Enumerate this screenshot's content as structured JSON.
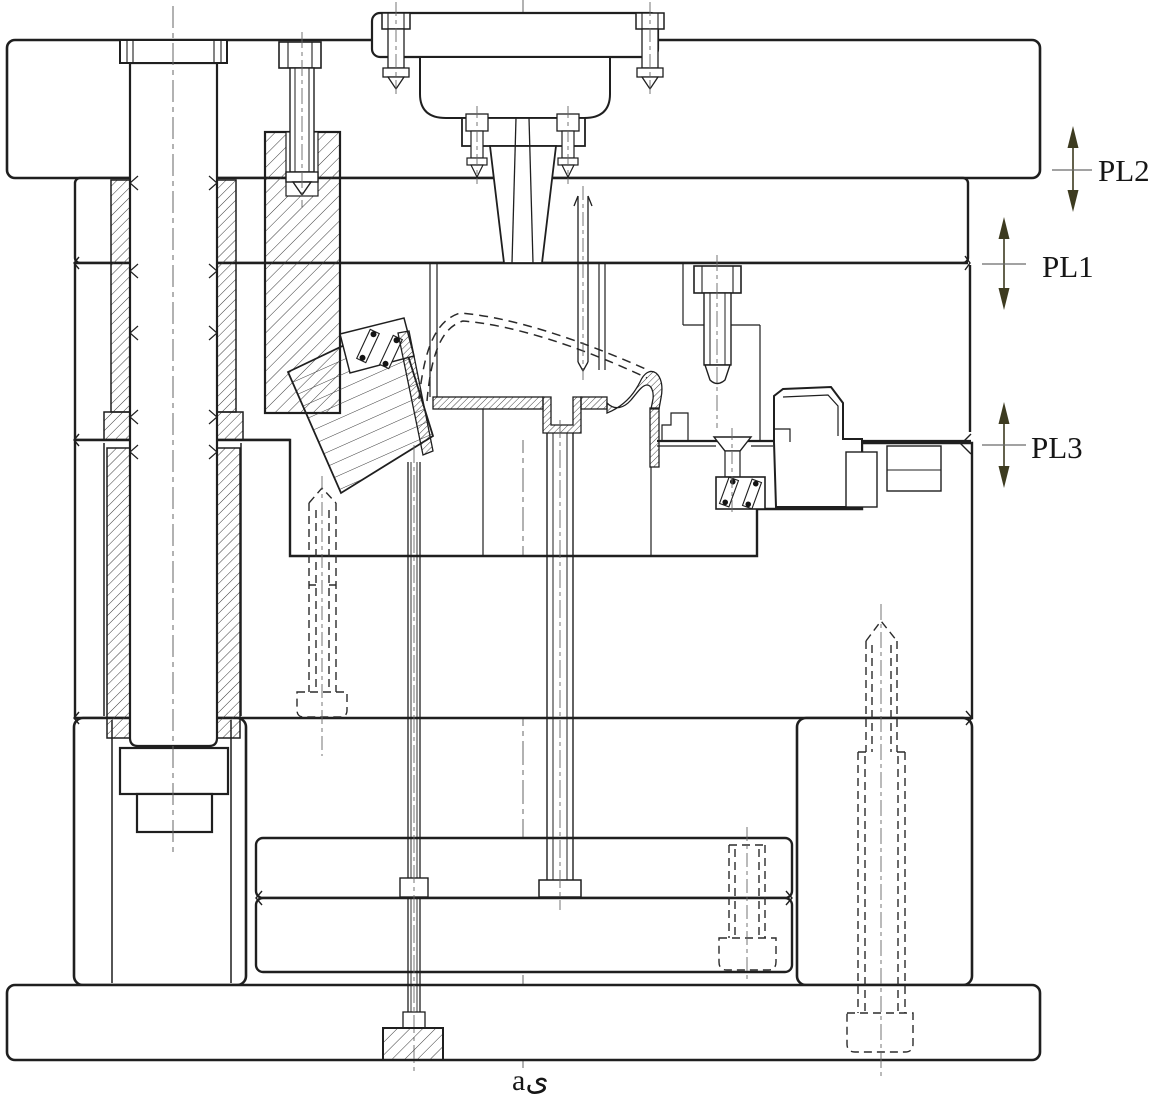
{
  "diagram": {
    "type": "technical-drawing",
    "subject": "three-plate injection mold cross-section",
    "caption": "aى",
    "parting_line_labels": [
      {
        "id": "PL2",
        "label": "PL2"
      },
      {
        "id": "PL1",
        "label": "PL1"
      },
      {
        "id": "PL3",
        "label": "PL3"
      }
    ],
    "colors": {
      "line": "#1f1f1f",
      "arrow": "#3d3b20",
      "hatch": "#3a3a3a",
      "background": "#ffffff"
    }
  }
}
